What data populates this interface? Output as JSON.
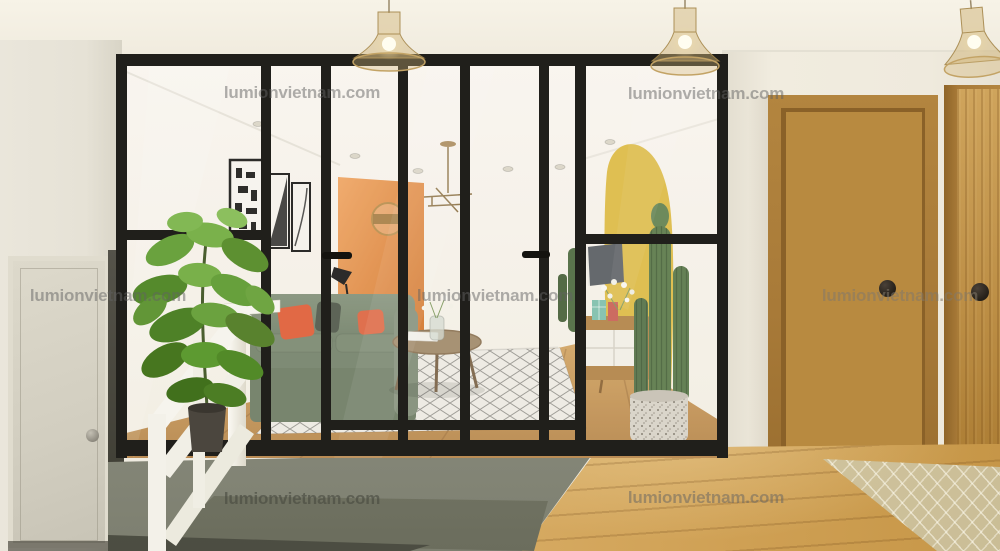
{
  "watermark": {
    "text": "lumionvietnam.com",
    "count": 7
  },
  "scene": {
    "type": "interior-architectural-render",
    "elements": [
      "glass-partition",
      "living-room",
      "sliding-doors",
      "pendant-lamps",
      "wooden-doors",
      "concrete-steps",
      "stair-railing",
      "fiddle-leaf-plant",
      "cactus",
      "sofa",
      "coffee-table",
      "tv-console"
    ],
    "palette": {
      "frame_black": "#201f1b",
      "wall_white": "#f0ece1",
      "orange_wall": "#e08a44",
      "yellow_mural": "#dcba40",
      "sofa_green": "#7b8a72",
      "pillow_orange": "#df5f39",
      "door_wood": "#b88a40",
      "floor_wood": "#cda052",
      "concrete_grey": "#8e9081",
      "plant_green": "#5f9434",
      "rug_white": "#edebe3",
      "rug_beige": "#d9cdaa",
      "lamp_brass": "#c8a568",
      "railing_white": "#f6f4ed"
    }
  }
}
